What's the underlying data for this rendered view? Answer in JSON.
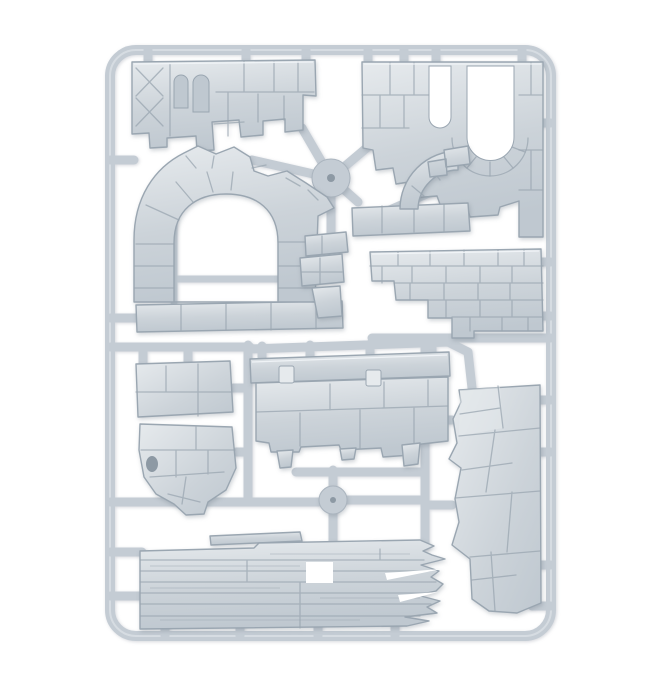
{
  "scene": {
    "description": "Product photo of a light grey plastic model sprue of ruined stone wall and rock terrain pieces on a white background",
    "subject": "plastic terrain model sprue",
    "background": "white studio backdrop",
    "material": "light grey polystyrene plastic"
  },
  "colors": {
    "background": "#ffffff",
    "plastic_base": "#ccd3d9",
    "plastic_light": "#e6eaed",
    "plastic_mid": "#bfc8d0",
    "plastic_dark": "#9aa6b1",
    "runner": "#c4ccd4",
    "runner_shadow": "#aab4be",
    "crack": "#99a5b0",
    "recess": "#8d99a4"
  },
  "sprue": {
    "frame_shape": "rounded rectangle runner frame",
    "hub_count": 2,
    "parts": [
      {
        "name": "ruined-wall-top",
        "description": "broken stone block wall with two arched niches and cross bracing"
      },
      {
        "name": "arch-channel-wall",
        "description": "stone wall with U-shaped arch channel and narrow slot"
      },
      {
        "name": "arched-doorway-ruin",
        "description": "ruined wall with arched doorway opening"
      },
      {
        "name": "arch-corner-fragment",
        "description": "curved arch fragment over a rubble strip"
      },
      {
        "name": "stepped-brick-wall",
        "description": "broken brick wall with stepped left edge"
      },
      {
        "name": "rubble-fragments",
        "description": "small broken masonry fragments"
      },
      {
        "name": "parapet-wall",
        "description": "wall section with top ledge, connector tabs and hanging stone legs"
      },
      {
        "name": "rock-slab",
        "description": "small flat rock slab"
      },
      {
        "name": "rock-outcrop",
        "description": "pointed rock outcrop"
      },
      {
        "name": "rock-face-panel",
        "description": "tall cliff rock face panel"
      },
      {
        "name": "plank-wall",
        "description": "wall of broken wooden planks with splintered ends"
      }
    ]
  }
}
